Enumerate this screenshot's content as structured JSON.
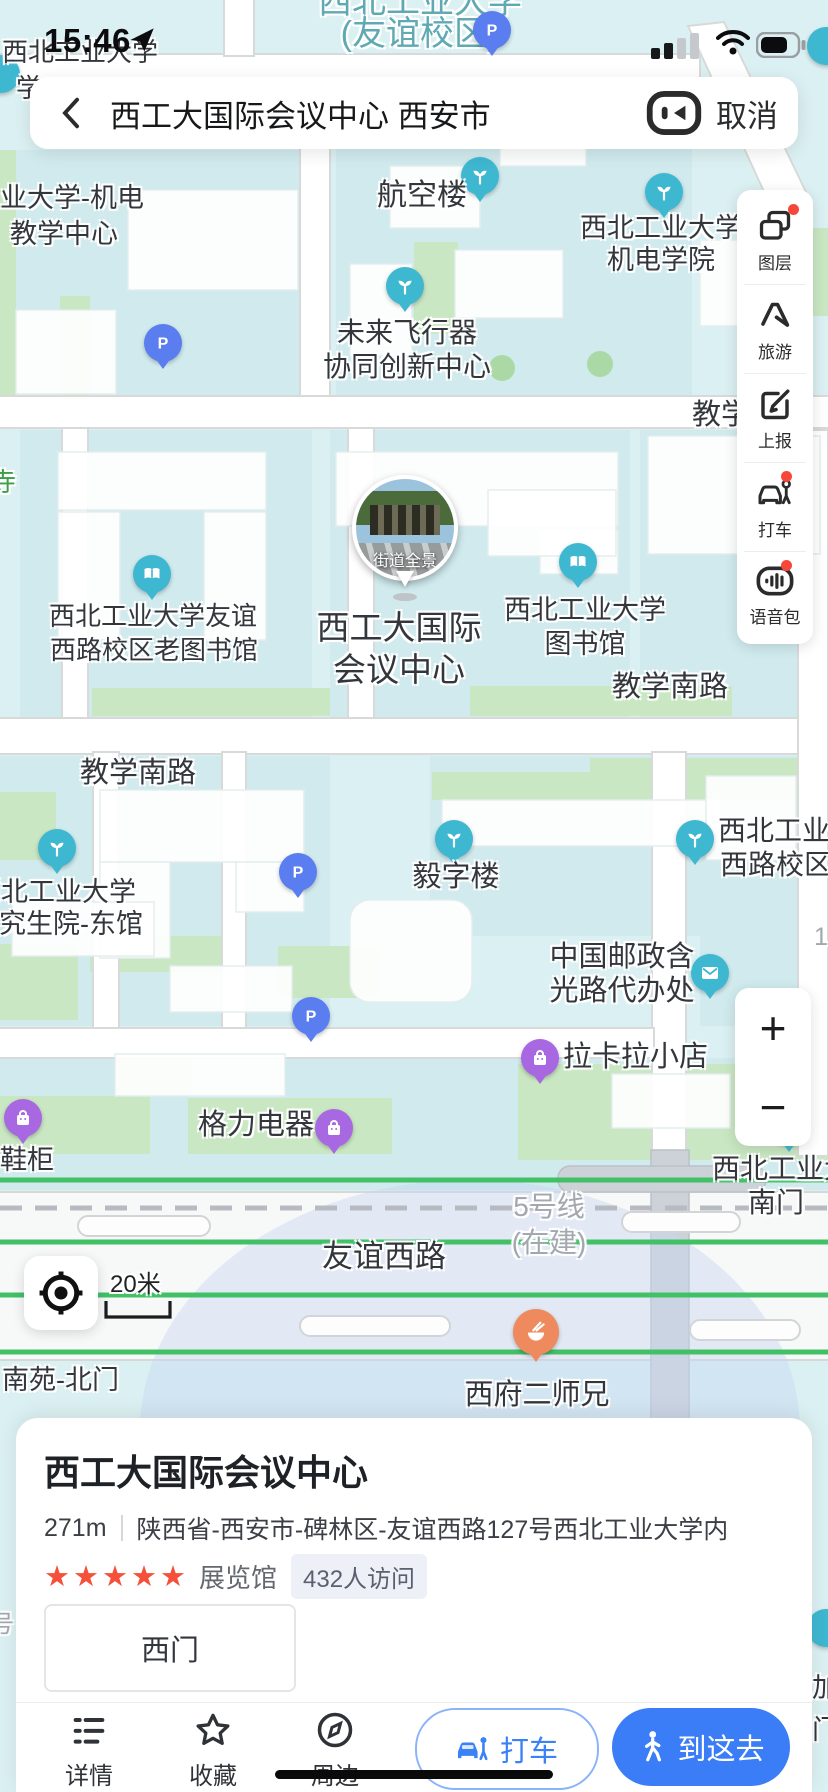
{
  "status_bar": {
    "time": "15:46"
  },
  "search": {
    "query": "西工大国际会议中心 西安市",
    "cancel": "取消"
  },
  "sidebar": {
    "items": [
      {
        "id": "layers",
        "label": "图层",
        "badge": true
      },
      {
        "id": "travel",
        "label": "旅游",
        "badge": false
      },
      {
        "id": "report",
        "label": "上报",
        "badge": false
      },
      {
        "id": "taxi",
        "label": "打车",
        "badge": true
      },
      {
        "id": "voice",
        "label": "语音包",
        "badge": true
      }
    ]
  },
  "zoom_controls": {
    "plus": "+",
    "minus": "−"
  },
  "scale": {
    "label": "20米"
  },
  "street_view": {
    "caption": "街道全景"
  },
  "map": {
    "road_labels": [
      {
        "id": "campus-title-line1",
        "text": "西北工业大学",
        "x": 420,
        "y": -16,
        "size": 34,
        "color": "teal",
        "align": "center"
      },
      {
        "id": "campus-title-line2",
        "text": "(友谊校区)",
        "x": 420,
        "y": 16,
        "size": 34,
        "color": "teal",
        "align": "center"
      },
      {
        "id": "road-jiaoxue-cut",
        "text": "教学",
        "x": 692,
        "y": 400,
        "size": 29,
        "color": "dark",
        "align": "left"
      },
      {
        "id": "temple-char",
        "text": "寺",
        "x": -10,
        "y": 468,
        "size": 26,
        "color": "green",
        "align": "left"
      },
      {
        "id": "road-jiaoxue-south-right",
        "text": "教学南路",
        "x": 612,
        "y": 672,
        "size": 29,
        "color": "dark",
        "align": "left"
      },
      {
        "id": "road-jiaoxue-south-left",
        "text": "教学南路",
        "x": 80,
        "y": 758,
        "size": 29,
        "color": "dark",
        "align": "left"
      },
      {
        "id": "digit-fragment",
        "text": "1",
        "x": 814,
        "y": 924,
        "size": 25,
        "color": "gray",
        "align": "left"
      },
      {
        "id": "metro-line5",
        "text": "5号线",
        "x": 549,
        "y": 1192,
        "size": 28,
        "color": "gray",
        "align": "center"
      },
      {
        "id": "metro-line5-status",
        "text": "(在建)",
        "x": 549,
        "y": 1228,
        "size": 28,
        "color": "gray",
        "align": "center"
      },
      {
        "id": "road-youyi-west",
        "text": "友谊西路",
        "x": 322,
        "y": 1240,
        "size": 31,
        "color": "dark",
        "align": "left"
      },
      {
        "id": "edge-hao-char",
        "text": "号",
        "x": -10,
        "y": 1612,
        "size": 24,
        "color": "gray",
        "align": "left"
      }
    ],
    "poi_labels": [
      {
        "id": "nwpu-topleft-line1",
        "text": "西北工业大学",
        "x": 2,
        "y": 38,
        "size": 26,
        "align": "left"
      },
      {
        "id": "nwpu-topleft-line2",
        "text": "学",
        "x": 16,
        "y": 74,
        "size": 26,
        "align": "left"
      },
      {
        "id": "jidian-center-line1",
        "text": "业大学-机电",
        "x": 0,
        "y": 184,
        "size": 27,
        "align": "left"
      },
      {
        "id": "jidian-center-line2",
        "text": "教学中心",
        "x": 10,
        "y": 220,
        "size": 27,
        "align": "left"
      },
      {
        "id": "hangkonglou",
        "text": "航空楼",
        "x": 377,
        "y": 180,
        "size": 30,
        "align": "left"
      },
      {
        "id": "jidian-college-line1",
        "text": "西北工业大学",
        "x": 661,
        "y": 214,
        "size": 27,
        "align": "center"
      },
      {
        "id": "jidian-college-line2",
        "text": "机电学院",
        "x": 661,
        "y": 246,
        "size": 27,
        "align": "center"
      },
      {
        "id": "weilai-line1",
        "text": "未来飞行器",
        "x": 407,
        "y": 318,
        "size": 28,
        "align": "center"
      },
      {
        "id": "weilai-line2",
        "text": "协同创新中心",
        "x": 407,
        "y": 352,
        "size": 28,
        "align": "center"
      },
      {
        "id": "old-library-line1",
        "text": "西北工业大学友谊",
        "x": 153,
        "y": 602,
        "size": 26,
        "align": "center"
      },
      {
        "id": "old-library-line2",
        "text": "西路校区老图书馆",
        "x": 154,
        "y": 636,
        "size": 26,
        "align": "center"
      },
      {
        "id": "conference-line1",
        "text": "西工大国际",
        "x": 399,
        "y": 610,
        "size": 33,
        "align": "center"
      },
      {
        "id": "conference-line2",
        "text": "会议中心",
        "x": 399,
        "y": 652,
        "size": 33,
        "align": "center"
      },
      {
        "id": "library-line1",
        "text": "西北工业大学",
        "x": 585,
        "y": 596,
        "size": 27,
        "align": "center"
      },
      {
        "id": "library-line2",
        "text": "图书馆",
        "x": 585,
        "y": 630,
        "size": 27,
        "align": "center"
      },
      {
        "id": "grad-school-line1",
        "text": "西北工业大学",
        "x": -26,
        "y": 878,
        "size": 27,
        "align": "left"
      },
      {
        "id": "grad-school-line2",
        "text": "研究生院-东馆",
        "x": -28,
        "y": 910,
        "size": 27,
        "align": "left"
      },
      {
        "id": "yizi-building",
        "text": "毅字楼",
        "x": 456,
        "y": 862,
        "size": 29,
        "align": "center"
      },
      {
        "id": "campus-west-line1",
        "text": "西北工业大",
        "x": 718,
        "y": 816,
        "size": 28,
        "align": "left"
      },
      {
        "id": "campus-west-line2",
        "text": "西路校区",
        "x": 720,
        "y": 850,
        "size": 28,
        "align": "left"
      },
      {
        "id": "post-office-line1",
        "text": "中国邮政含",
        "x": 622,
        "y": 942,
        "size": 29,
        "align": "center"
      },
      {
        "id": "post-office-line2",
        "text": "光路代办处",
        "x": 622,
        "y": 976,
        "size": 29,
        "align": "center"
      },
      {
        "id": "lakala-shop",
        "text": "拉卡拉小店",
        "x": 563,
        "y": 1042,
        "size": 29,
        "align": "left"
      },
      {
        "id": "geli-appliance",
        "text": "格力电器",
        "x": 198,
        "y": 1110,
        "size": 29,
        "align": "left"
      },
      {
        "id": "xiegui-shop",
        "text": "鞋柜",
        "x": 0,
        "y": 1146,
        "size": 27,
        "align": "left"
      },
      {
        "id": "south-gate-line1",
        "text": "西北工业大",
        "x": 712,
        "y": 1154,
        "size": 28,
        "align": "left"
      },
      {
        "id": "south-gate-line2",
        "text": "南门",
        "x": 748,
        "y": 1188,
        "size": 28,
        "align": "left"
      },
      {
        "id": "nanyuan-north-gate",
        "text": "南苑-北门",
        "x": 2,
        "y": 1366,
        "size": 27,
        "align": "left"
      },
      {
        "id": "xifu-restaurant",
        "text": "西府二师兄",
        "x": 537,
        "y": 1380,
        "size": 29,
        "align": "center"
      },
      {
        "id": "edge-jia-char",
        "text": "加",
        "x": 812,
        "y": 1674,
        "size": 27,
        "align": "left"
      },
      {
        "id": "edge-men-char",
        "text": "门",
        "x": 812,
        "y": 1716,
        "size": 27,
        "align": "left"
      }
    ],
    "markers": [
      {
        "id": "parking-top",
        "type": "parking",
        "x": 492,
        "y": 30
      },
      {
        "id": "poi-edge-topleft",
        "type": "dot",
        "x": 1,
        "y": 74
      },
      {
        "id": "hangkonglou-marker",
        "type": "sprout",
        "x": 480,
        "y": 176
      },
      {
        "id": "jidian-college-marker",
        "type": "sprout",
        "x": 664,
        "y": 192
      },
      {
        "id": "weilai-marker",
        "type": "sprout",
        "x": 405,
        "y": 286
      },
      {
        "id": "parking-1",
        "type": "parking",
        "x": 163,
        "y": 343
      },
      {
        "id": "old-library-marker",
        "type": "book",
        "x": 152,
        "y": 574
      },
      {
        "id": "library-marker",
        "type": "book",
        "x": 578,
        "y": 562
      },
      {
        "id": "grad-school-marker",
        "type": "sprout",
        "x": 57,
        "y": 848
      },
      {
        "id": "yizi-marker",
        "type": "sprout",
        "x": 454,
        "y": 839
      },
      {
        "id": "campus-west-marker",
        "type": "sprout",
        "x": 695,
        "y": 839
      },
      {
        "id": "parking-2",
        "type": "parking",
        "x": 298,
        "y": 872
      },
      {
        "id": "parking-3",
        "type": "parking",
        "x": 311,
        "y": 1016
      },
      {
        "id": "post-office-marker",
        "type": "mail",
        "x": 710,
        "y": 973
      },
      {
        "id": "lakala-marker",
        "type": "bag",
        "x": 540,
        "y": 1058
      },
      {
        "id": "geli-marker",
        "type": "bag",
        "x": 334,
        "y": 1128
      },
      {
        "id": "xiegui-marker",
        "type": "bag",
        "x": 23,
        "y": 1118
      },
      {
        "id": "south-gate-marker",
        "type": "sprout",
        "x": 789,
        "y": 1126
      },
      {
        "id": "food-marker",
        "type": "food",
        "x": 536,
        "y": 1332
      },
      {
        "id": "poi-edge-right-top",
        "type": "dot",
        "x": 826,
        "y": 46
      },
      {
        "id": "poi-edge-right-bottom",
        "type": "dot",
        "x": 826,
        "y": 1628
      }
    ]
  },
  "card": {
    "title": "西工大国际会议中心",
    "distance": "271m",
    "address": "陕西省-西安市-碑林区-友谊西路127号西北工业大学内",
    "stars": "★★★★★",
    "category": "展览馆",
    "visitors": "432人访问",
    "gate": "西门",
    "actions": [
      {
        "id": "details",
        "label": "详情"
      },
      {
        "id": "favorite",
        "label": "收藏"
      },
      {
        "id": "nearby",
        "label": "周边"
      }
    ],
    "taxi_label": "打车",
    "go_label": "到这去"
  },
  "colors": {
    "accent_blue": "#3b7df7",
    "star_red": "#f5503a",
    "marker_teal": "#3eb7d0",
    "marker_parking": "#5a7df0",
    "marker_purple": "#a868e2",
    "marker_food": "#ee8a5d",
    "label_dark": "#33373c",
    "label_teal": "#5fa9b3",
    "label_gray": "#a3a8ae",
    "label_green": "#3da048",
    "road_green": "#41c065",
    "badge_red": "#f5483b"
  }
}
